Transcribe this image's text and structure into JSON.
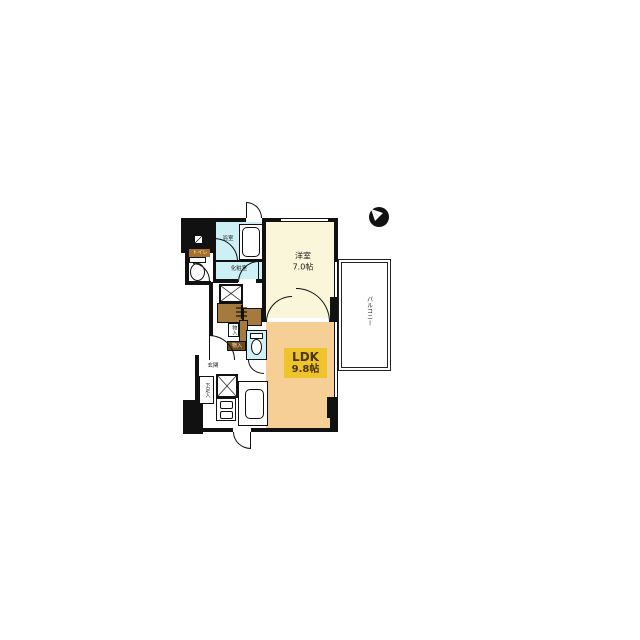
{
  "plan": {
    "type": "japanese-apartment-floor-plan",
    "rooms": {
      "bedroom": {
        "name": "洋室",
        "size": "7.0帖"
      },
      "ldk": {
        "name": "LDK",
        "size": "9.8帖"
      },
      "balcony": {
        "name": "バルコニー"
      },
      "bath": {
        "name": "浴室"
      },
      "powder": {
        "name": "化粧室"
      },
      "toilet": {
        "name": "トイレ"
      },
      "entrance": {
        "name": "玄関"
      },
      "shoe": {
        "name": "下足入"
      },
      "storage_a": {
        "name": "物入"
      },
      "storage_b": {
        "name": "物入"
      }
    },
    "colors": {
      "wall": "#111111",
      "bedroom_floor": "#FAF6D9",
      "ldk_floor": "#F6CF97",
      "wet_area": "#CDEFF6",
      "closet": "#A47A3E",
      "ldk_label_bg": "#EFC32A",
      "ldk_label_text": "#4A3400",
      "toilet_label_bg": "#A8702C",
      "toilet_label_text": "#FFE3BC",
      "storage_dark_bg": "#6E4B20",
      "storage_dark_text": "#FFE8C4"
    },
    "icons": {
      "north_arrow": "compass-north-arrow",
      "hanger_rod": "closet-hanger-rod",
      "service_box": "crossed-service-space",
      "washer_meter": "diagonal-marked-box"
    }
  }
}
